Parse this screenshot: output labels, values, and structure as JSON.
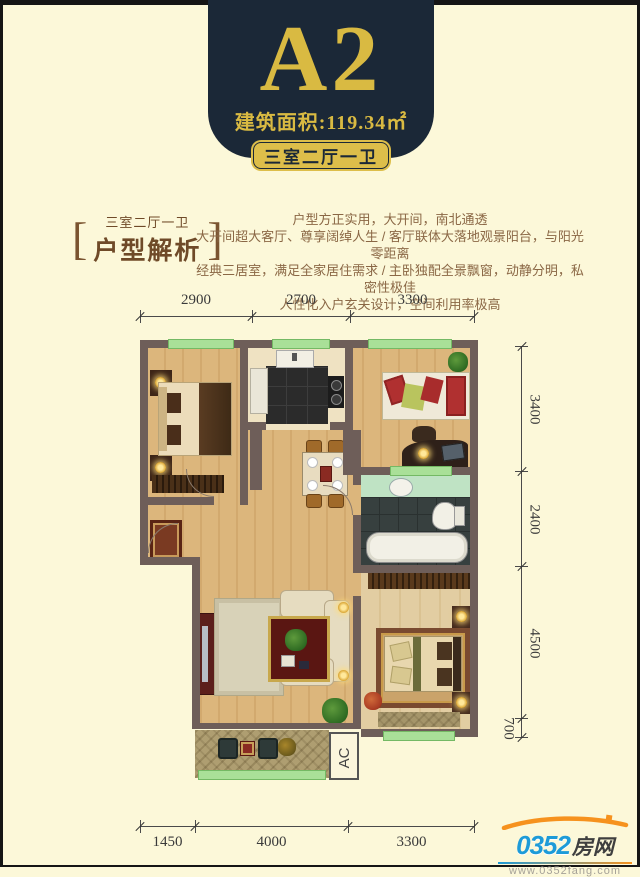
{
  "banner": {
    "model": "A2",
    "area": "建筑面积:119.34㎡",
    "tag": "三室二厅一卫"
  },
  "section": {
    "bracket_left": "[",
    "bracket_right": "]",
    "tag_line": "三室二厅一卫",
    "title": "户型解析",
    "lines": [
      "户型方正实用，大开间，南北通透",
      "大开间超大客厅、尊享阔绰人生 / 客厅联体大落地观景阳台，与阳光零距离",
      "经典三居室，满足全家居住需求 / 主卧独配全景飘窗，动静分明，私密性极佳",
      "人性化入户玄关设计，空间利用率极高"
    ]
  },
  "dims": {
    "top": [
      "2900",
      "2700",
      "3300"
    ],
    "right": [
      "3400",
      "2400",
      "4500",
      "700"
    ],
    "bottom": [
      "1450",
      "4000",
      "3300"
    ]
  },
  "plan": {
    "ac_label": "AC"
  },
  "logo": {
    "number": "0352",
    "suffix": "房网",
    "url": "www.0352fang.com"
  },
  "colors": {
    "background": "#fcf8d9",
    "banner_navy": "#1b2837",
    "gold": "#d9ba42",
    "text_brown": "#8a6745",
    "wall": "#6e5e59",
    "window_green": "#a9e098",
    "logo_blue": "#1e9bd8",
    "logo_orange": "#f6921e"
  }
}
